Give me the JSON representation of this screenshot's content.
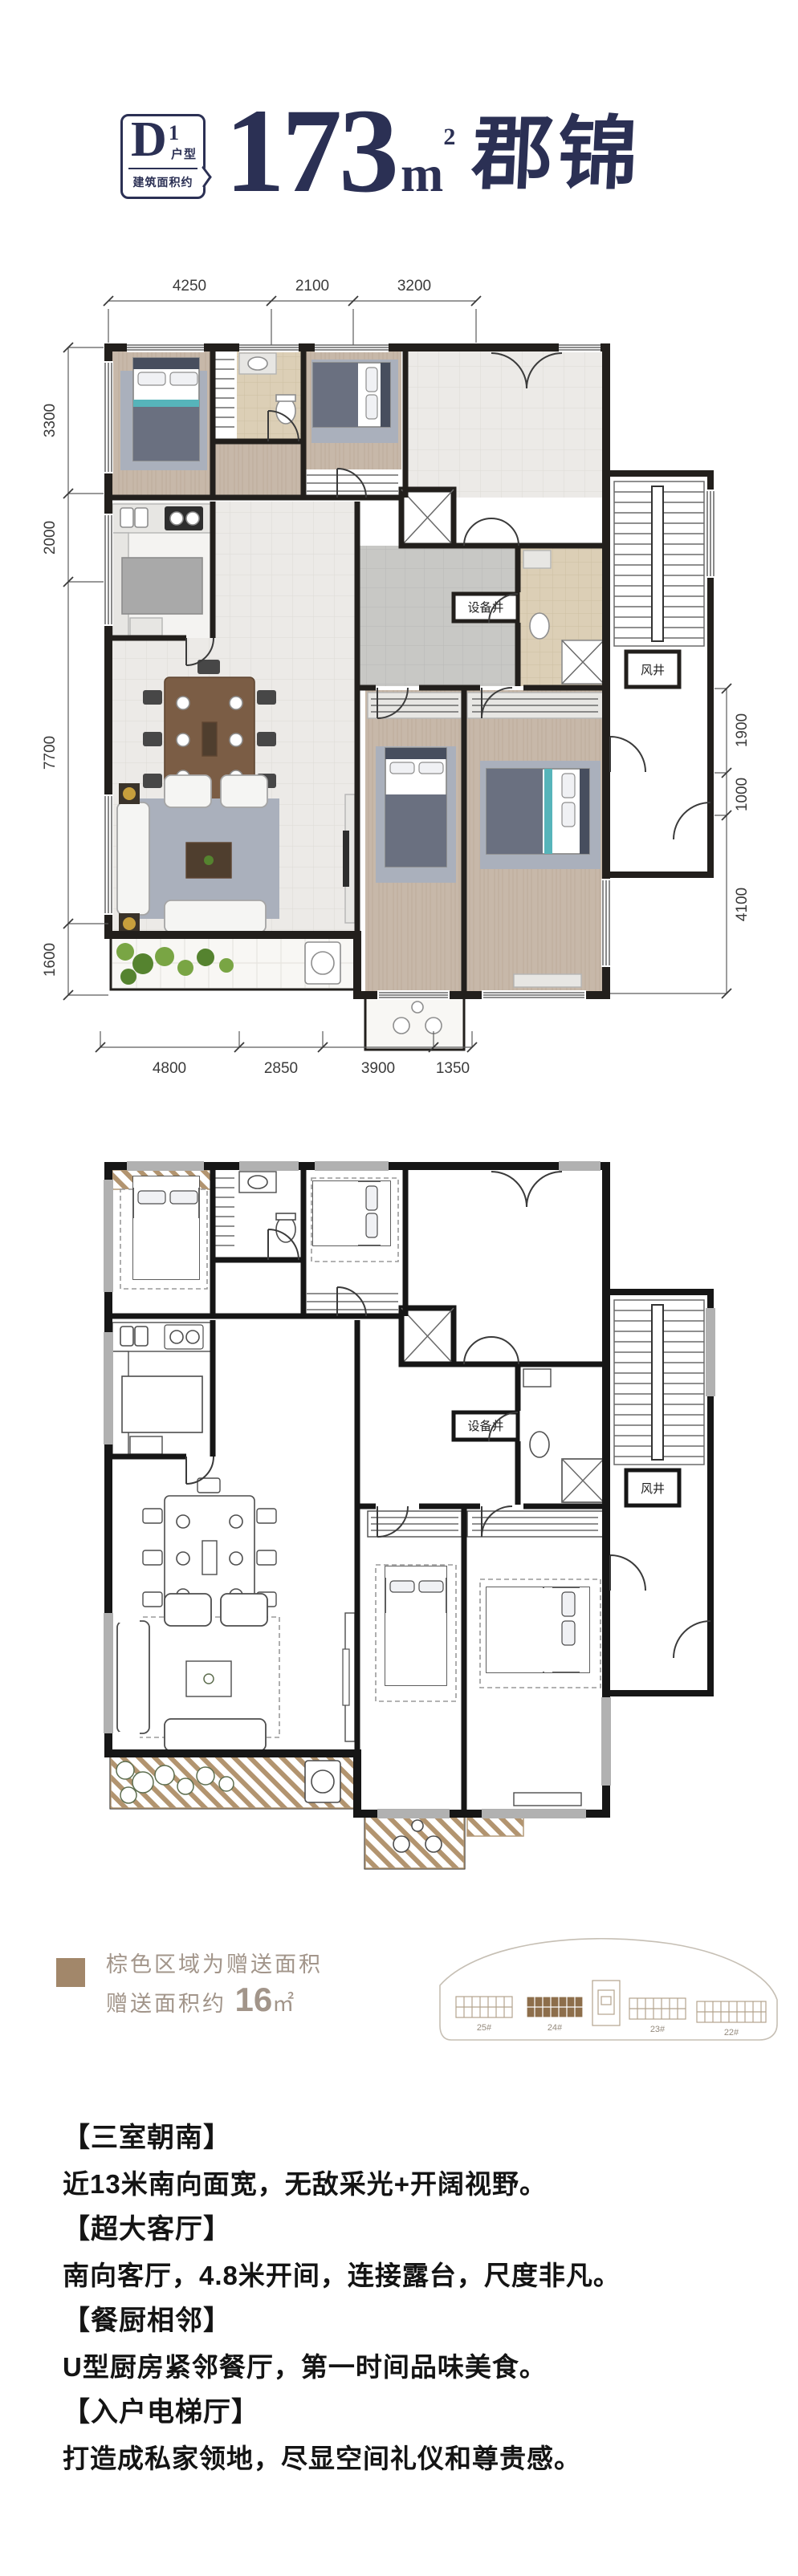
{
  "header": {
    "badge": {
      "letter": "D",
      "superscript": "1",
      "type_label": "户型",
      "area_label": "建筑面积约"
    },
    "area_number": "173",
    "area_unit": "m",
    "area_exponent": "2",
    "project_name": "郡锦"
  },
  "plan_labels": {
    "equipment_shaft": "设备井",
    "wind_shaft": "风井"
  },
  "plan1": {
    "dims_top": [
      "4250",
      "2100",
      "3200"
    ],
    "dims_left": [
      "3300",
      "2000",
      "7700",
      "1600"
    ],
    "dims_right": [
      "1900",
      "1000",
      "4100"
    ],
    "dims_bottom": [
      "4800",
      "2850",
      "3900",
      "1350"
    ]
  },
  "legend": {
    "line1": "棕色区域为赠送面积",
    "line2_label": "赠送面积约",
    "line2_value": "16",
    "line2_unit": "㎡",
    "swatch_color": "#a2876a",
    "highlighted_building": "24#",
    "buildings": [
      "25#",
      "24#",
      "23#",
      "22#"
    ]
  },
  "features": [
    {
      "title": "【三室朝南】",
      "desc": "近13米南向面宽，无敌采光+开阔视野。"
    },
    {
      "title": "【超大客厅】",
      "desc": "南向客厅，4.8米开间，连接露台，尺度非凡。"
    },
    {
      "title": "【餐厨相邻】",
      "desc": "U型厨房紧邻餐厅，第一时间品味美食。"
    },
    {
      "title": "【入户电梯厅】",
      "desc": "打造成私家领地，尽显空间礼仪和尊贵感。"
    }
  ]
}
